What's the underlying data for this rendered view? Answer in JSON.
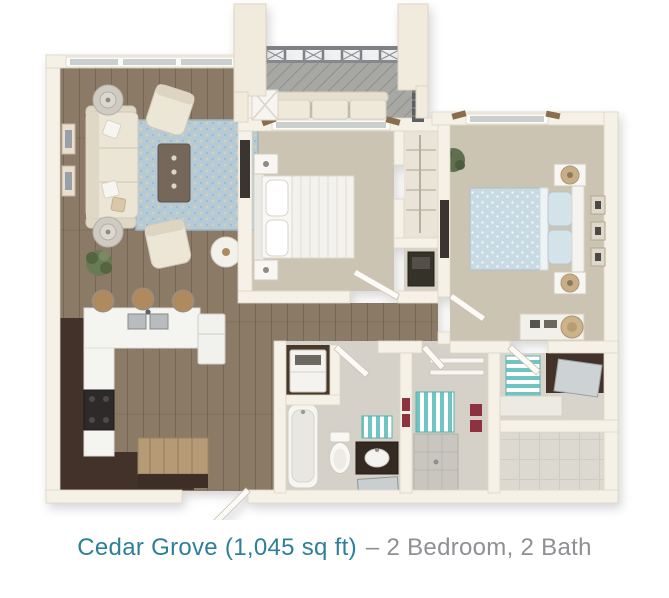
{
  "caption": {
    "name_and_size": "Cedar Grove (1,045 sq ft)",
    "specs_with_separator": "– 2 Bedroom, 2 Bath",
    "full": "Cedar Grove (1,045 sq ft) – 2 Bedroom, 2 Bath"
  },
  "palette": {
    "caption_teal": "#2e7f99",
    "caption_gray": "#8f9094",
    "wall_cream": "#f5f1e7",
    "wood_floor": "#8b7a66",
    "carpet": "#ccc4b2",
    "tile": "#d5d1c8",
    "deck_gray": "#a7a7a4",
    "rug_blue": "#b4cbd7",
    "bed_blue": "#c8dae4",
    "cabinet_brown": "#42302a",
    "counter_white": "#f4f4f1",
    "teal_accent": "#6fc5c3",
    "towel_red": "#8e3040"
  }
}
